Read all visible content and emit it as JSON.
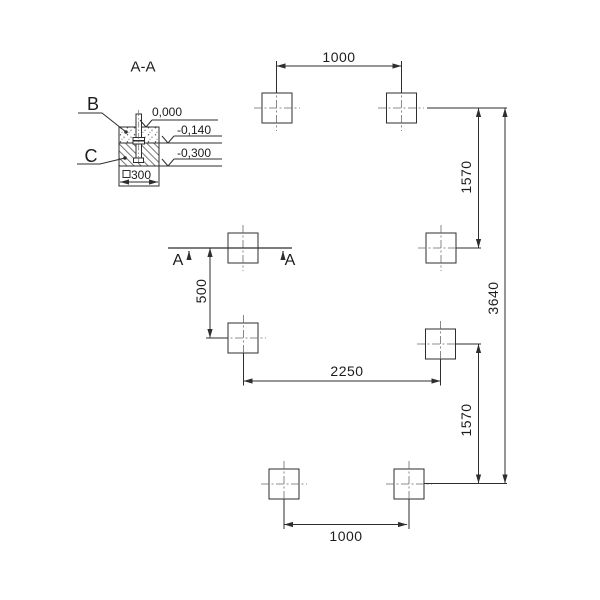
{
  "section_detail": {
    "title": "A-A",
    "label_b": "B",
    "label_c": "C",
    "elevation_top": "0,000",
    "elevation_mid": "-0,140",
    "elevation_bottom": "-0,300",
    "base_size": "300"
  },
  "section_cut": {
    "label_left": "A",
    "label_right": "A"
  },
  "dimensions": {
    "top_spacing": "1000",
    "bottom_spacing": "1000",
    "middle_spacing": "2250",
    "right_upper": "1570",
    "right_lower": "1570",
    "overall_height": "3640",
    "section_offset": "500"
  },
  "colors": {
    "line": "#2e2e2e",
    "centerline": "#6a6a6a",
    "background": "#ffffff"
  }
}
